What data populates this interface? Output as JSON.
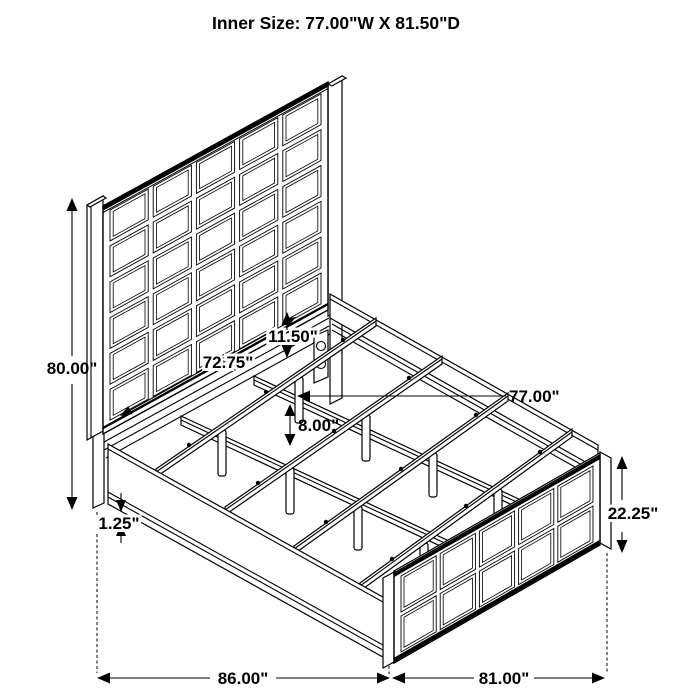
{
  "title": "Inner Size: 77.00\"W X 81.50\"D",
  "labels": {
    "overall_height": "80.00\"",
    "headboard_panel_width": "72.75\"",
    "headboard_rail_gap": "11.50\"",
    "inner_width": "77.00\"",
    "under_bed_clearance": "8.00\"",
    "rail_lip": "1.25\"",
    "footboard_height": "22.25\"",
    "overall_length": "86.00\"",
    "footboard_length": "81.00\""
  },
  "colors": {
    "line": "#000000",
    "background": "#ffffff"
  }
}
